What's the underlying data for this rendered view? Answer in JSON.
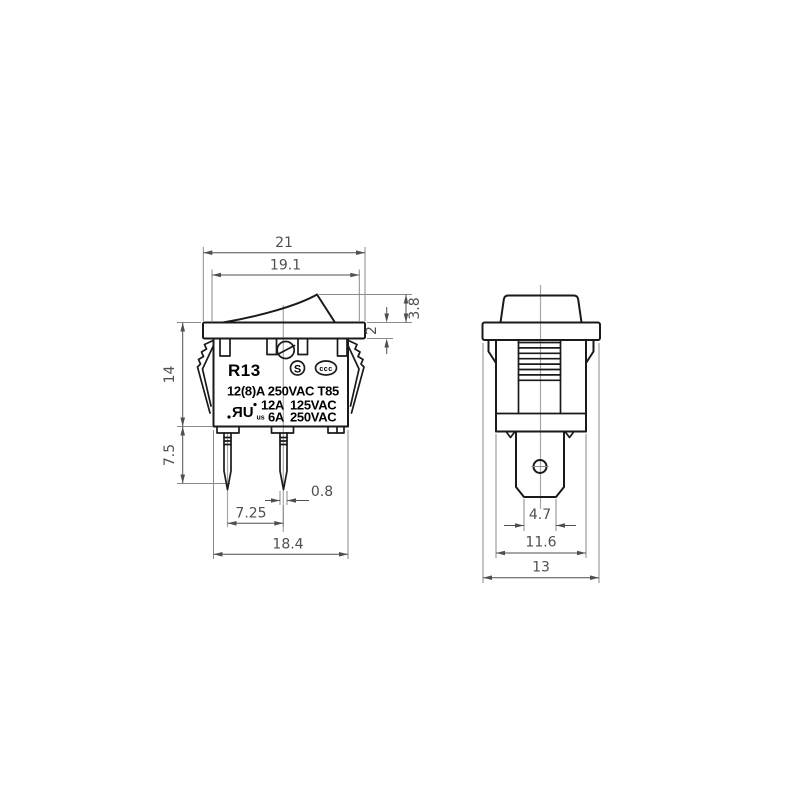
{
  "colors": {
    "outline": "#1a1a1a",
    "dim": "#4f4f4f",
    "ext": "#8a8a8a",
    "center": "#a8a8a8",
    "mark": "#000000",
    "bg": "#ffffff"
  },
  "dimensions": {
    "front": {
      "flange_width": "21",
      "inner_width": "19.1",
      "rocker_height": "3.8",
      "flange_thickness": "2",
      "body_height": "14",
      "pin_length": "7.5",
      "pin_width": "0.8",
      "pin_pitch": "7.25",
      "body_width": "18.4"
    },
    "side": {
      "terminal_width": "4.7",
      "body_depth": "11.6",
      "flange_depth": "13"
    }
  },
  "markings": {
    "model": "R13",
    "rating_primary": "12(8)A 250VAC T85",
    "rating2_amps": "12A",
    "rating2_volts": "125VAC",
    "rating3_amps": "6A",
    "rating3_volts": "250VAC",
    "cert_s": "S",
    "cert_ccc": "ccc",
    "cert_ur": "ЯU",
    "cert_ur_sub": "us"
  }
}
